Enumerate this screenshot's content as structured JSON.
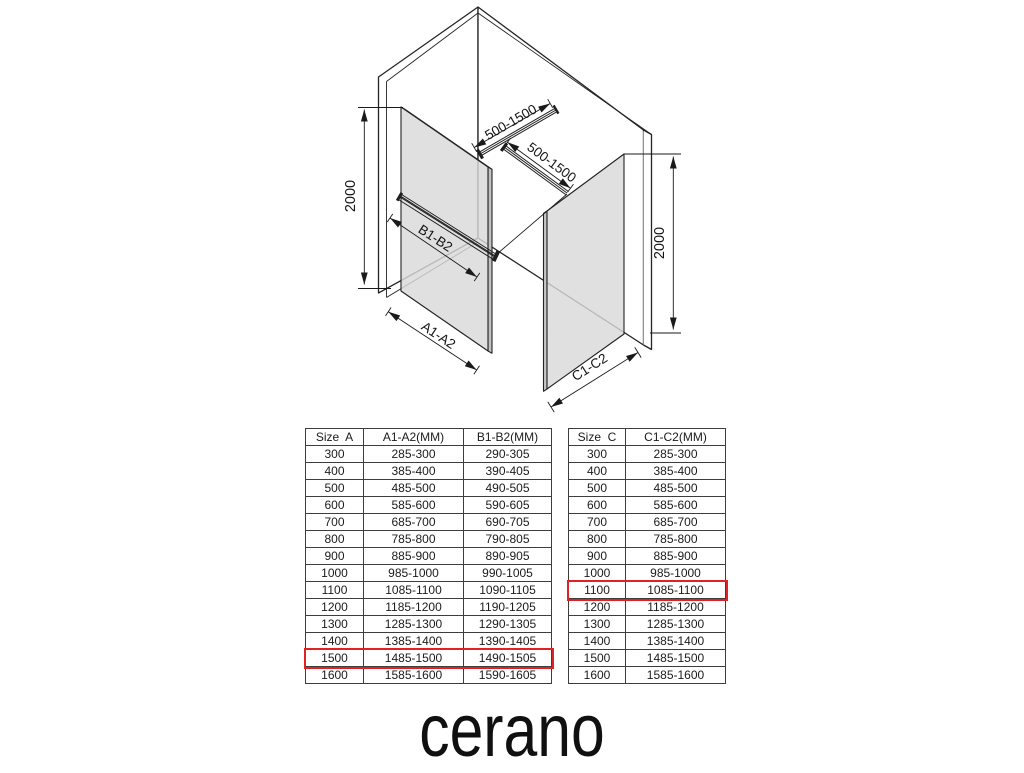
{
  "diagram": {
    "labels": {
      "height_left": "2000",
      "height_right": "2000",
      "bar1": "500-1500",
      "bar2": "500-1500",
      "panel_a_width": "A1-A2",
      "panel_a_bar": "B1-B2",
      "panel_c_width": "C1-C2"
    }
  },
  "tables": {
    "size_a": {
      "headers": [
        "Size  A",
        "A1-A2(MM)",
        "B1-B2(MM)"
      ],
      "rows": [
        [
          "300",
          "285-300",
          "290-305"
        ],
        [
          "400",
          "385-400",
          "390-405"
        ],
        [
          "500",
          "485-500",
          "490-505"
        ],
        [
          "600",
          "585-600",
          "590-605"
        ],
        [
          "700",
          "685-700",
          "690-705"
        ],
        [
          "800",
          "785-800",
          "790-805"
        ],
        [
          "900",
          "885-900",
          "890-905"
        ],
        [
          "1000",
          "985-1000",
          "990-1005"
        ],
        [
          "1100",
          "1085-1100",
          "1090-1105"
        ],
        [
          "1200",
          "1185-1200",
          "1190-1205"
        ],
        [
          "1300",
          "1285-1300",
          "1290-1305"
        ],
        [
          "1400",
          "1385-1400",
          "1390-1405"
        ],
        [
          "1500",
          "1485-1500",
          "1490-1505"
        ],
        [
          "1600",
          "1585-1600",
          "1590-1605"
        ]
      ],
      "highlighted_row": "1500"
    },
    "size_c": {
      "headers": [
        "Size  C",
        "C1-C2(MM)"
      ],
      "rows": [
        [
          "300",
          "285-300"
        ],
        [
          "400",
          "385-400"
        ],
        [
          "500",
          "485-500"
        ],
        [
          "600",
          "585-600"
        ],
        [
          "700",
          "685-700"
        ],
        [
          "800",
          "785-800"
        ],
        [
          "900",
          "885-900"
        ],
        [
          "1000",
          "985-1000"
        ],
        [
          "1100",
          "1085-1100"
        ],
        [
          "1200",
          "1185-1200"
        ],
        [
          "1300",
          "1285-1300"
        ],
        [
          "1400",
          "1385-1400"
        ],
        [
          "1500",
          "1485-1500"
        ],
        [
          "1600",
          "1585-1600"
        ]
      ],
      "highlighted_row": "1100"
    }
  },
  "branding": {
    "logo": "cerano"
  },
  "colors": {
    "highlight": "#e02222",
    "glass": "#d9d9d9",
    "line": "#1f1f1f"
  }
}
